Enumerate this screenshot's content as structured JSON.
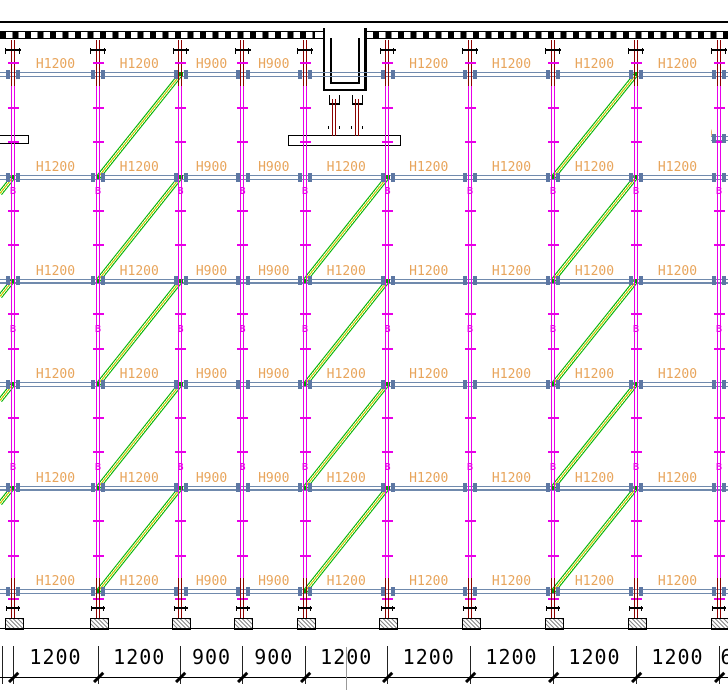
{
  "drawing": {
    "title": "formwork scaffold elevation",
    "splice_mark": "B",
    "edge_fragment": "0",
    "levels": [
      {
        "bays": [
          "H1200",
          "H1200",
          "H900",
          "H900",
          null,
          "H1200",
          "H1200",
          "H1200",
          "H1200"
        ]
      },
      {
        "bays": [
          "H1200",
          "H1200",
          "H900",
          "H900",
          "H1200",
          "H1200",
          "H1200",
          "H1200",
          "H1200"
        ]
      },
      {
        "bays": [
          "H1200",
          "H1200",
          "H900",
          "H900",
          "H1200",
          "H1200",
          "H1200",
          "H1200",
          "H1200"
        ]
      },
      {
        "bays": [
          "H1200",
          "H1200",
          "H900",
          "H900",
          "H1200",
          "H1200",
          "H1200",
          "H1200",
          "H1200"
        ]
      },
      {
        "bays": [
          "H1200",
          "H1200",
          "H900",
          "H900",
          "H1200",
          "H1200",
          "H1200",
          "H1200",
          "H1200"
        ]
      },
      {
        "bays": [
          "H1200",
          "H1200",
          "H900",
          "H900",
          "H1200",
          "H1200",
          "H1200",
          "H1200",
          "H1200"
        ]
      }
    ],
    "dimensions": [
      "1200",
      "1200",
      "900",
      "900",
      "1200",
      "1200",
      "1200",
      "1200",
      "1200"
    ],
    "dimension_partial": "600",
    "colors": {
      "post_magenta": "#E800E8",
      "jack_maroon": "#8B0000",
      "ledger_blue": "#708AAD",
      "node_blue": "#5D77A3",
      "brace_green": "#00B400",
      "brace_core_yellow": "#C8C800",
      "label_orange": "#E8A55C",
      "line_black": "#000000"
    }
  }
}
